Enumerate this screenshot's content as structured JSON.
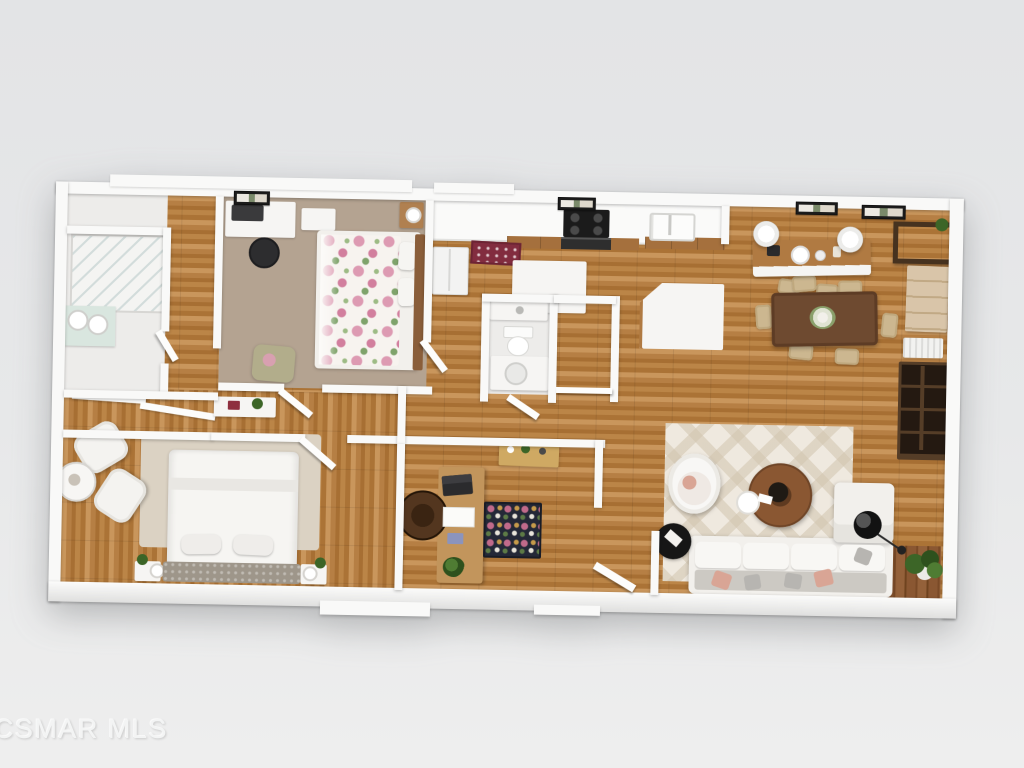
{
  "watermark": {
    "text": "CSMAR MLS"
  },
  "palette": {
    "background": "#e7e8e9",
    "wall": "#f9f9f8",
    "floor_wood": "#b67f44",
    "floor_wood_dark": "#a76f33",
    "floor_wood_light": "#c9965c",
    "carpet": "#b4a391",
    "tile": "#edecea",
    "rug_primary_bedroom": "#dbd2c3",
    "rug_living": "#efe9df",
    "rug_office": "#242837",
    "rug_kitchen": "#822c3f",
    "sofa": "#f2f0ec",
    "dining_table": "#6e4a30",
    "dining_chair": "#ccb790",
    "dark_wood": "#46321f",
    "hutch": "#d9c5a9",
    "desk_wood": "#c2955c",
    "island_wood": "#b07a42",
    "cabinet_wood": "#a5703d",
    "floral_pink": "#dd9ab2",
    "leaf_green": "#7fa36b",
    "plant_green": "#3c6527",
    "headboard": "#9e968a",
    "pillow_blush": "#d9a595",
    "pillow_gray": "#b7b5b1",
    "watermark": "#f3f4f4"
  },
  "scene": {
    "type": "3d-rendered-floor-plan",
    "view": "top-down",
    "rooms": [
      {
        "name": "primary-bathroom",
        "floor": "tile",
        "furniture": [
          "walk-in-shower",
          "double-sink-vanity"
        ]
      },
      {
        "name": "walk-in-closet",
        "floor": "wood",
        "furniture": [
          "sliding-doors",
          "hall-console"
        ]
      },
      {
        "name": "bedroom-2",
        "floor": "carpet",
        "furniture": [
          "floral-bed",
          "desk-with-monitor",
          "office-chair",
          "loveseat",
          "nightstand",
          "wall-shelf"
        ]
      },
      {
        "name": "primary-bedroom",
        "floor": "wood",
        "furniture": [
          "bed",
          "tufted-headboard",
          "area-rug",
          "nightstand-left",
          "nightstand-right",
          "armchair-pair",
          "round-side-table"
        ]
      },
      {
        "name": "hall-bathroom",
        "floor": "tile",
        "furniture": [
          "toilet",
          "vanity-sink",
          "counter"
        ]
      },
      {
        "name": "kitchen",
        "floor": "wood",
        "furniture": [
          "cooktop",
          "oven",
          "double-basin-sink",
          "refrigerator",
          "kitchen-island",
          "prep-island",
          "breakfast-bar",
          "pendant-lights",
          "bar-stools",
          "kitchen-rug"
        ]
      },
      {
        "name": "dining-area",
        "floor": "wood",
        "furniture": [
          "dining-table",
          "six-dining-chairs",
          "flower-centerpiece",
          "console-table",
          "hutch-cabinet",
          "radiator",
          "wall-art"
        ]
      },
      {
        "name": "living-room",
        "floor": "wood",
        "furniture": [
          "sectional-sofa",
          "throw-pillows",
          "round-coffee-table",
          "egg-chair",
          "black-side-table",
          "arc-floor-lamp",
          "diamond-rug",
          "media-bookcase",
          "potted-plant",
          "entry-deck",
          "entry-door"
        ]
      },
      {
        "name": "office",
        "floor": "wood",
        "furniture": [
          "l-shaped-desk",
          "desk-chair",
          "laptop",
          "floral-rug",
          "console-table",
          "desk-plant"
        ]
      }
    ]
  }
}
